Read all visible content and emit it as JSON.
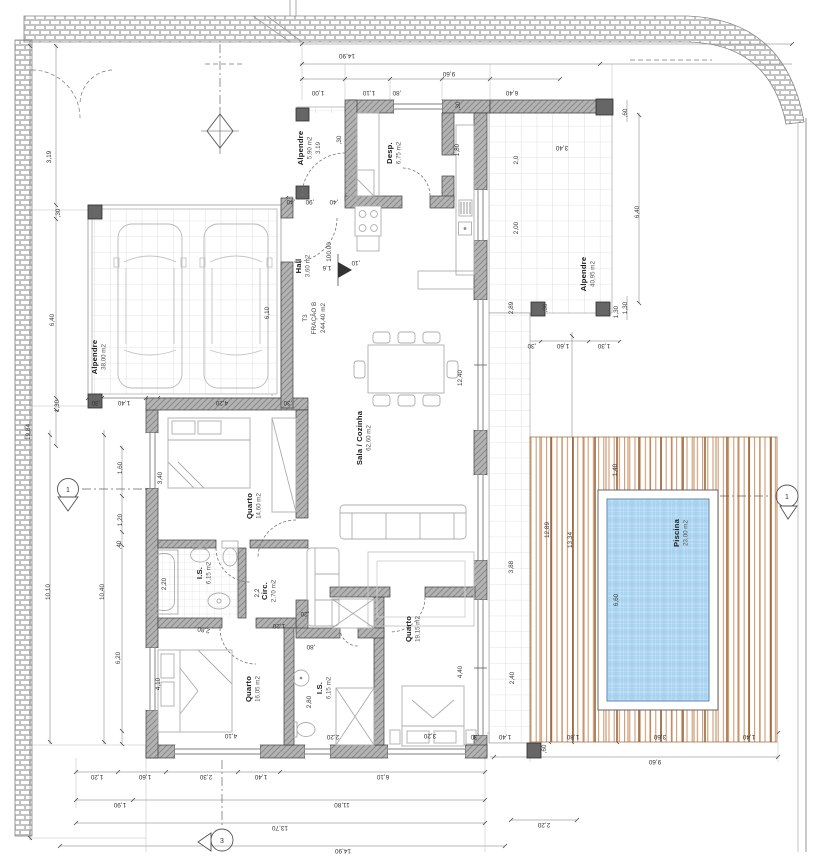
{
  "drawing": {
    "title": "floor-plan T3 dwelling with pool",
    "unit_label": {
      "line1": "T3",
      "line2": "FRAÇÃO B",
      "line3": "244,40 m2"
    },
    "level_marker": "100.00",
    "markers": {
      "left": "1",
      "right": "1",
      "bottom": "3"
    },
    "colors": {
      "wall_fill": "#b3b3b3",
      "wall_hatch": "#8a8a8a",
      "wall_line": "#3f3f3f",
      "pillar": "#666666",
      "tile_line": "#c9c9c9",
      "brick_line": "#9a9a9a",
      "pool_water": "#a9d4f1",
      "pool_edge": "#4d7ba6",
      "deck_light": "#cb9266",
      "deck_dark": "#8e5527",
      "dim_line": "#777777",
      "dim_text": "#333333",
      "furniture": "#adadad"
    },
    "rooms": [
      {
        "name": "Alpendre",
        "area": "38,00 m2",
        "x": 97,
        "y": 357
      },
      {
        "name": "Alpendre",
        "area": "5,90 m2",
        "extra": "3.19",
        "x": 303,
        "y": 148
      },
      {
        "name": "Desp.",
        "area": "6,75 m2",
        "x": 392,
        "y": 153
      },
      {
        "name": "Hall",
        "area": "3,60 m2",
        "x": 301,
        "y": 266
      },
      {
        "name": "Sala / Cozinha",
        "area": "62,60 m2",
        "x": 362,
        "y": 438
      },
      {
        "name": "Quarto",
        "area": "14,60 m2",
        "x": 252,
        "y": 506
      },
      {
        "name": "I.S.",
        "area": "6,15 m2",
        "x": 202,
        "y": 573
      },
      {
        "name": "Circ.",
        "area": "2,70 m2",
        "x": 267,
        "y": 591
      },
      {
        "name": "Quarto",
        "area": "16,05 m2",
        "x": 251,
        "y": 689
      },
      {
        "name": "I.S.",
        "area": "6,15 m2",
        "x": 322,
        "y": 688
      },
      {
        "name": "Quarto",
        "area": "19,15 m2",
        "x": 411,
        "y": 629
      },
      {
        "name": "Alpendre",
        "area": "40,95 m2",
        "x": 586,
        "y": 274
      },
      {
        "name": "Piscina",
        "area": "23,00 m2",
        "x": 679,
        "y": 533
      }
    ],
    "dim_labels": [
      {
        "t": "14,90",
        "x": 347,
        "y": 54,
        "r": 180
      },
      {
        "t": "9,60",
        "x": 449,
        "y": 72,
        "r": 180
      },
      {
        "t": "1,00",
        "x": 318,
        "y": 91,
        "r": 180
      },
      {
        "t": "1,10",
        "x": 369,
        "y": 91,
        "r": 180
      },
      {
        "t": ",80",
        "x": 397,
        "y": 91,
        "r": 180
      },
      {
        "t": "6,40",
        "x": 512,
        "y": 91,
        "r": 180
      },
      {
        "t": "3,40",
        "x": 562,
        "y": 146,
        "r": 180
      },
      {
        "t": ",30",
        "x": 460,
        "y": 106,
        "r": -90
      },
      {
        "t": "1,80",
        "x": 459,
        "y": 150,
        "r": -90
      },
      {
        "t": ",30",
        "x": 341,
        "y": 140,
        "r": -90
      },
      {
        "t": ",40",
        "x": 291,
        "y": 200,
        "r": 180
      },
      {
        "t": ",90",
        "x": 310,
        "y": 200,
        "r": 180
      },
      {
        "t": ",40",
        "x": 334,
        "y": 200,
        "r": 180
      },
      {
        "t": "1,6",
        "x": 327,
        "y": 266,
        "r": 180
      },
      {
        "t": ",10",
        "x": 356,
        "y": 261,
        "r": 180
      },
      {
        "t": "2,0",
        "x": 518,
        "y": 160,
        "r": -90
      },
      {
        "t": "2,00",
        "x": 518,
        "y": 228,
        "r": -90
      },
      {
        "t": "2,89",
        "x": 513,
        "y": 308,
        "r": -90
      },
      {
        "t": ",30",
        "x": 547,
        "y": 308,
        "r": -90
      },
      {
        "t": ",60",
        "x": 627,
        "y": 113,
        "r": -90
      },
      {
        "t": "6,40",
        "x": 639,
        "y": 212,
        "r": -90
      },
      {
        "t": "1,30",
        "x": 627,
        "y": 308,
        "r": -90
      },
      {
        "t": ",30",
        "x": 532,
        "y": 344,
        "r": 180
      },
      {
        "t": "1,60",
        "x": 563,
        "y": 344,
        "r": 180
      },
      {
        "t": "1,30",
        "x": 604,
        "y": 344,
        "r": 180
      },
      {
        "t": "1,30",
        "x": 618,
        "y": 312,
        "r": -90
      },
      {
        "t": "19,84",
        "x": 30,
        "y": 432,
        "r": -90
      },
      {
        "t": "10,10",
        "x": 50,
        "y": 592,
        "r": -90
      },
      {
        "t": "10,40",
        "x": 104,
        "y": 592,
        "r": -90
      },
      {
        "t": "3,19",
        "x": 51,
        "y": 157,
        "r": -90
      },
      {
        "t": ",30",
        "x": 60,
        "y": 213,
        "r": -90
      },
      {
        "t": "6,40",
        "x": 54,
        "y": 320,
        "r": -90
      },
      {
        "t": "1,30",
        "x": 59,
        "y": 406,
        "r": -90
      },
      {
        "t": "1,60",
        "x": 122,
        "y": 468,
        "r": -90
      },
      {
        "t": "1,20",
        "x": 122,
        "y": 520,
        "r": -90
      },
      {
        "t": ",40",
        "x": 121,
        "y": 545,
        "r": -90
      },
      {
        "t": "6,20",
        "x": 120,
        "y": 658,
        "r": -90
      },
      {
        "t": ",30",
        "x": 96,
        "y": 401,
        "r": 180
      },
      {
        "t": "1,40",
        "x": 124,
        "y": 401,
        "r": 180
      },
      {
        "t": "4,20",
        "x": 222,
        "y": 401,
        "r": 180
      },
      {
        "t": ",30",
        "x": 288,
        "y": 401,
        "r": 180
      },
      {
        "t": "6,10",
        "x": 269,
        "y": 313,
        "r": -90
      },
      {
        "t": "3,40",
        "x": 162,
        "y": 478,
        "r": -90
      },
      {
        "t": "2,20",
        "x": 166,
        "y": 584,
        "r": -90
      },
      {
        "t": "4,10",
        "x": 160,
        "y": 684,
        "r": -90
      },
      {
        "t": "2,80",
        "x": 204,
        "y": 628,
        "r": 190
      },
      {
        "t": ",20",
        "x": 305,
        "y": 612,
        "r": 180
      },
      {
        "t": "1,20",
        "x": 279,
        "y": 624,
        "r": 180
      },
      {
        "t": ",80",
        "x": 311,
        "y": 645,
        "r": 180
      },
      {
        "t": "2,2",
        "x": 259,
        "y": 593,
        "r": -90
      },
      {
        "t": "12,40",
        "x": 462,
        "y": 378,
        "r": -90
      },
      {
        "t": "3,88",
        "x": 513,
        "y": 567,
        "r": -90
      },
      {
        "t": "2,40",
        "x": 514,
        "y": 678,
        "r": -90
      },
      {
        "t": "4,40",
        "x": 462,
        "y": 672,
        "r": -90
      },
      {
        "t": "2,80",
        "x": 311,
        "y": 702,
        "r": -90
      },
      {
        "t": "2,20",
        "x": 333,
        "y": 735,
        "r": 180
      },
      {
        "t": "3,20",
        "x": 430,
        "y": 734,
        "r": 180
      },
      {
        "t": "4,10",
        "x": 231,
        "y": 734,
        "r": 180
      },
      {
        "t": "12,89",
        "x": 549,
        "y": 530,
        "r": -90
      },
      {
        "t": "13,34",
        "x": 572,
        "y": 540,
        "r": -90
      },
      {
        "t": "1,40",
        "x": 617,
        "y": 470,
        "r": -90
      },
      {
        "t": "6,60",
        "x": 618,
        "y": 600,
        "r": -90
      },
      {
        "t": ",30",
        "x": 475,
        "y": 735,
        "r": 180
      },
      {
        "t": "1,40",
        "x": 505,
        "y": 735,
        "r": 180
      },
      {
        "t": ",60",
        "x": 546,
        "y": 749,
        "r": -90
      },
      {
        "t": "1,80",
        "x": 573,
        "y": 735,
        "r": 180
      },
      {
        "t": "3,60",
        "x": 660,
        "y": 735,
        "r": 180
      },
      {
        "t": "1,40",
        "x": 749,
        "y": 735,
        "r": 180
      },
      {
        "t": "9,60",
        "x": 655,
        "y": 760,
        "r": 180
      },
      {
        "t": "2,20",
        "x": 544,
        "y": 823,
        "r": 180
      },
      {
        "t": "1,20",
        "x": 97,
        "y": 775,
        "r": 180
      },
      {
        "t": "1,60",
        "x": 145,
        "y": 775,
        "r": 180
      },
      {
        "t": "2,30",
        "x": 206,
        "y": 775,
        "r": 180
      },
      {
        "t": "1,40",
        "x": 261,
        "y": 775,
        "r": 180
      },
      {
        "t": "6,10",
        "x": 383,
        "y": 775,
        "r": 180
      },
      {
        "t": "1,90",
        "x": 120,
        "y": 803,
        "r": 180
      },
      {
        "t": "11,80",
        "x": 342,
        "y": 803,
        "r": 180
      },
      {
        "t": "13,70",
        "x": 280,
        "y": 826,
        "r": 180
      },
      {
        "t": "14,90",
        "x": 343,
        "y": 849,
        "r": 180
      }
    ]
  }
}
